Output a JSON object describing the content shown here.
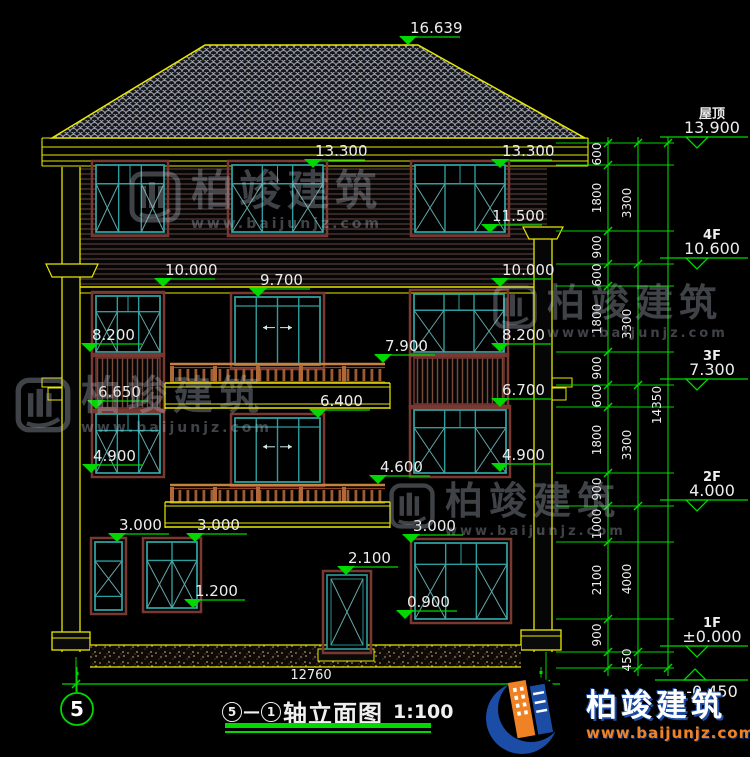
{
  "drawing": {
    "axis_left": "5",
    "axis_right": "1",
    "title_sep": "—",
    "title": "轴立面图",
    "scale": "1:100"
  },
  "marks": {
    "peak": "16.639",
    "eave_l": "13.300",
    "eave_r": "13.300",
    "sill4f_r": "11.500",
    "lvl10_l": "10.000",
    "lvl10_r": "10.000",
    "door3f": "9.700",
    "sill3f_l": "8.200",
    "sill3f_r": "8.200",
    "rail3f": "7.900",
    "louv_l": "6.650",
    "louv_r": "6.700",
    "door2f": "6.400",
    "sill2f_l": "4.900",
    "sill2f_r": "4.900",
    "rail2f": "4.600",
    "win1f_a": "3.000",
    "win1f_b": "3.000",
    "win1f_c": "3.000",
    "door1f": "2.100",
    "sill1f_m": "1.200",
    "sill1f_r": "0.900"
  },
  "floors": [
    {
      "label": "屋顶",
      "value": "13.900"
    },
    {
      "label": "4F",
      "value": "10.600"
    },
    {
      "label": "3F",
      "value": "7.300"
    },
    {
      "label": "2F",
      "value": "4.000"
    },
    {
      "label": "1F",
      "value": "±0.000"
    },
    {
      "label": "",
      "value": "-0.450"
    }
  ],
  "dims": {
    "inner": [
      "600",
      "1800",
      "900",
      "600",
      "1800",
      "900",
      "600",
      "1800",
      "900",
      "1000",
      "2100",
      "900"
    ],
    "middle": [
      "3300",
      "3300",
      "3300",
      "4000",
      "450"
    ],
    "outer": [
      "14350"
    ],
    "width": "12760"
  },
  "watermark": {
    "brand": "柏竣建筑",
    "site": "www.baijunjz.com"
  },
  "logo": {
    "brand": "柏竣建筑",
    "site": "www.baijunjz.com"
  },
  "colors": {
    "dimension_green": "#00d800",
    "trim_yellow": "#e8e800",
    "window_teal": "#2d9e9e",
    "trim_maroon": "#7a3832",
    "logo_blue": "#1c4da6",
    "logo_orange": "#f08226"
  }
}
